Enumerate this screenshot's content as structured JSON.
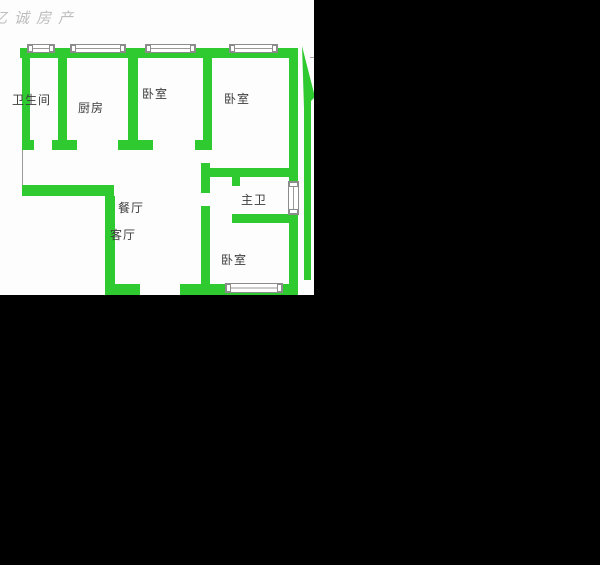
{
  "watermark": "亿诚房产",
  "colors": {
    "wall_green": "#2fca2f",
    "background": "#000000",
    "floor_white": "#fdfdfd",
    "label_text": "#3d3d3d",
    "window_border": "#8c8c8c",
    "watermark_gray": "#bdbdbd"
  },
  "floorplan": {
    "type": "apartment-floor-plan",
    "rooms": [
      {
        "id": "bathroom",
        "label": "卫生间"
      },
      {
        "id": "kitchen",
        "label": "厨房"
      },
      {
        "id": "bedroom-top-left",
        "label": "卧室"
      },
      {
        "id": "bedroom-top-right",
        "label": "卧室"
      },
      {
        "id": "master-bathroom",
        "label": "主卫"
      },
      {
        "id": "bedroom-bottom",
        "label": "卧室"
      },
      {
        "id": "dining-room",
        "label": "餐厅"
      },
      {
        "id": "living-room",
        "label": "客厅"
      }
    ],
    "symbols": {
      "windows": 6,
      "compass": "north-arrow"
    }
  }
}
